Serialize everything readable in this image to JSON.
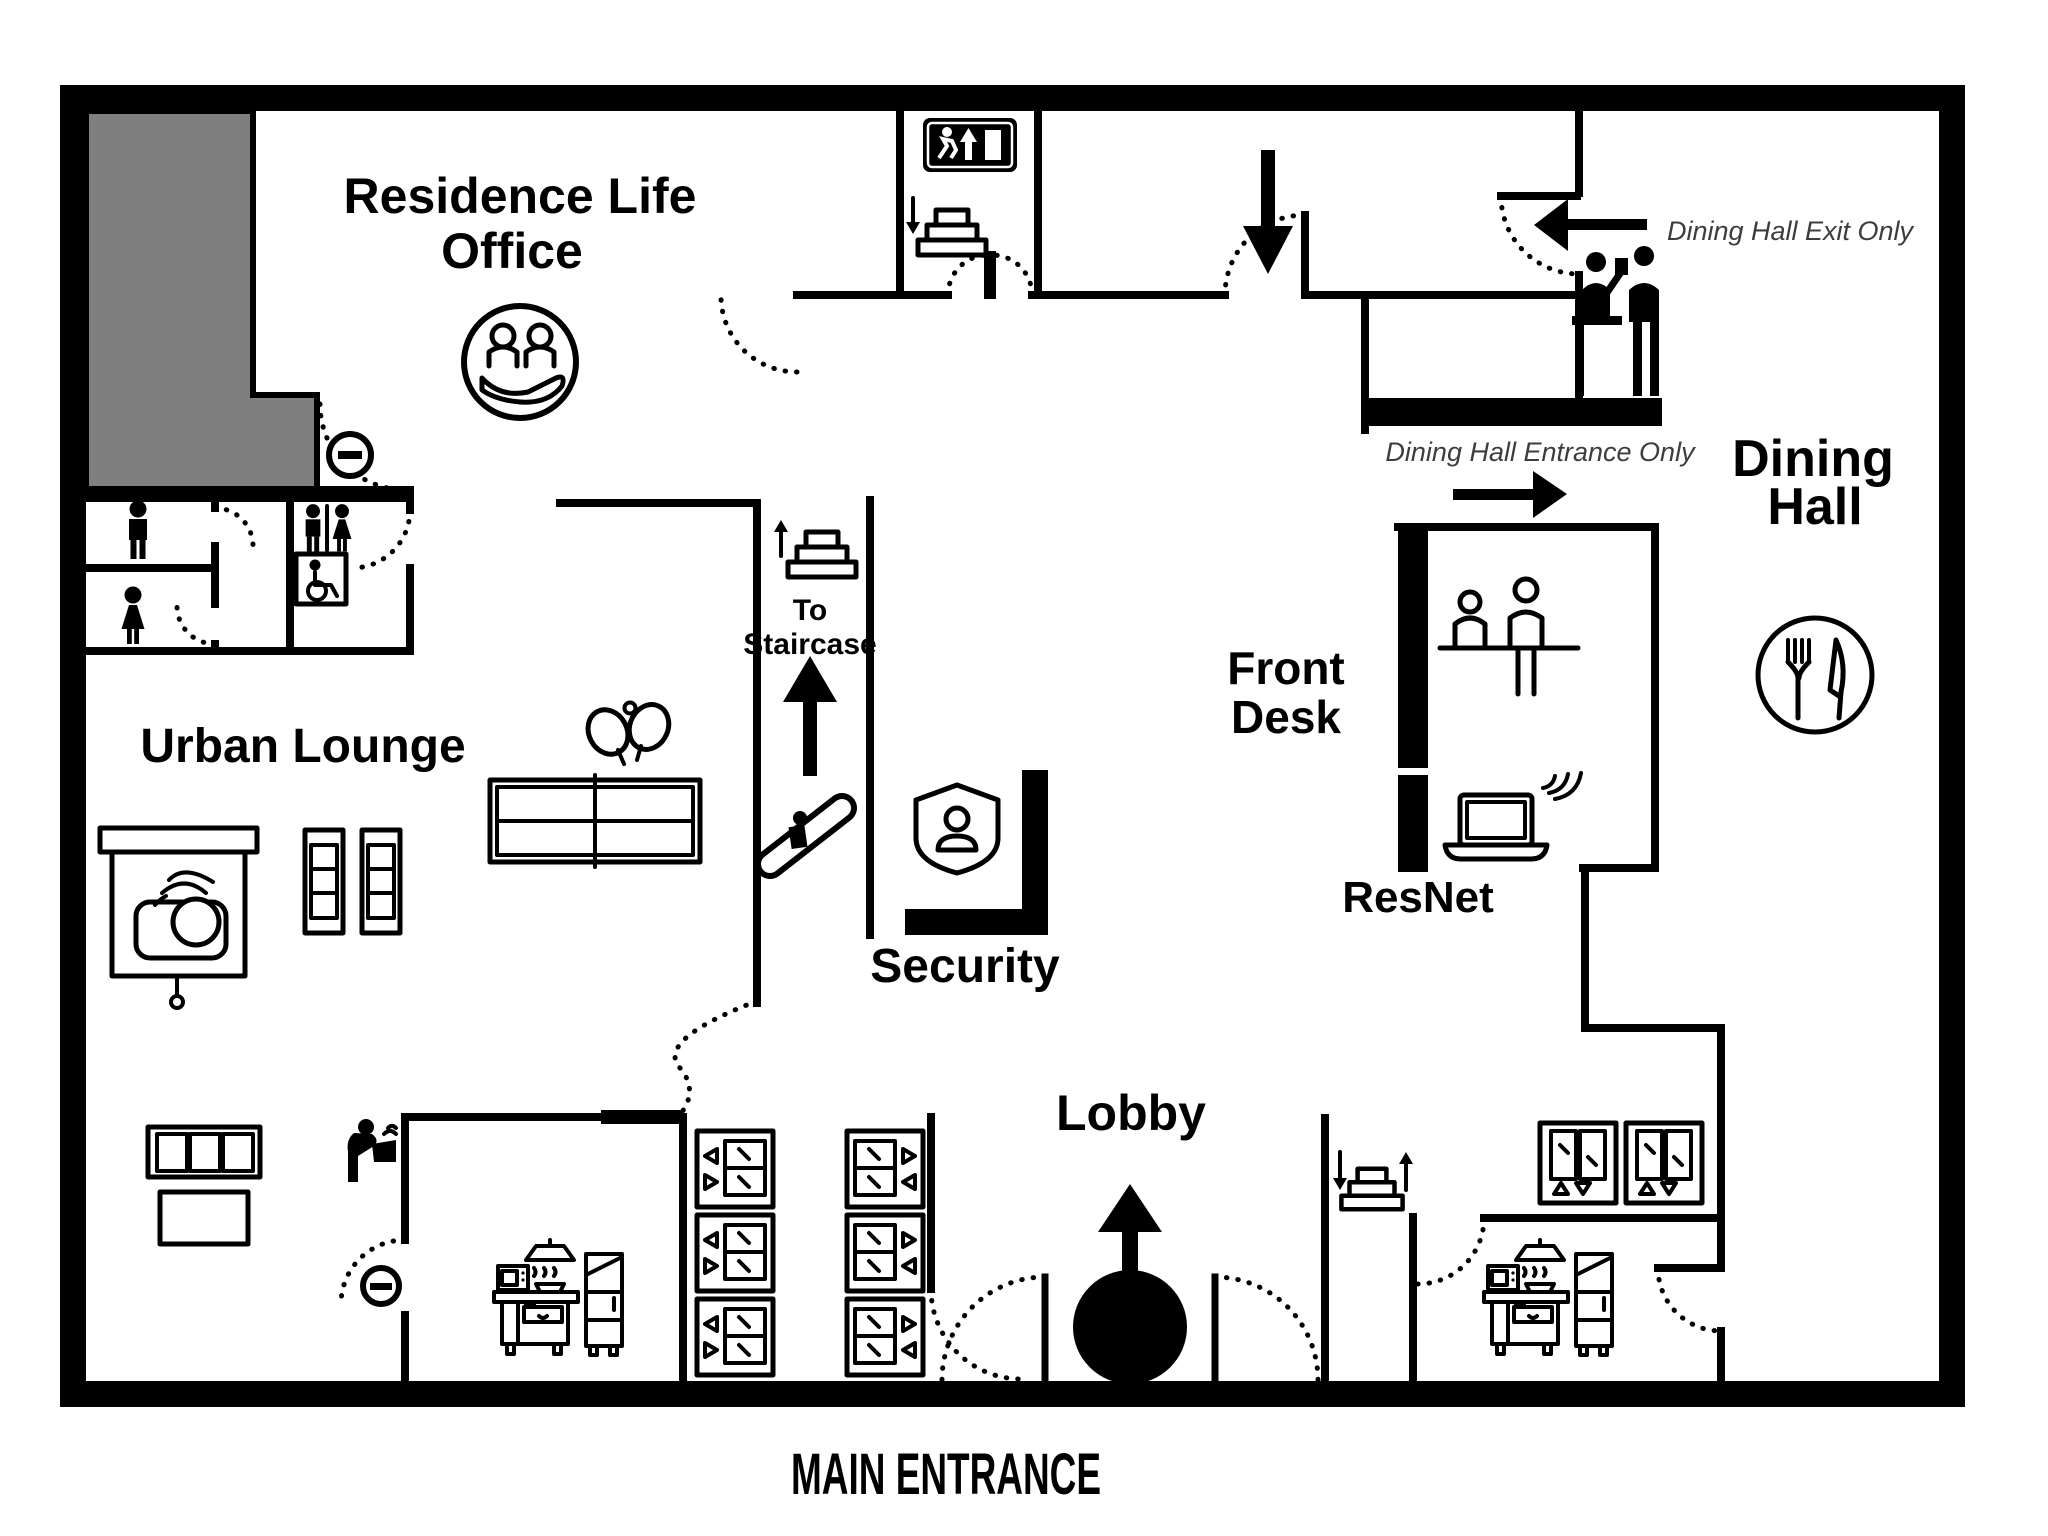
{
  "colors": {
    "wall": "#000000",
    "restricted_area_fill": "#7f7f7f",
    "background": "#ffffff",
    "annotation_text": "#3d3d3d"
  },
  "rooms": {
    "residence_life_office": {
      "line1": "Residence Life",
      "line2": "Office"
    },
    "urban_lounge": {
      "label": "Urban Lounge"
    },
    "security": {
      "label": "Security"
    },
    "lobby": {
      "label": "Lobby"
    },
    "front_desk": {
      "line1": "Front",
      "line2": "Desk"
    },
    "resnet": {
      "label": "ResNet"
    },
    "dining_hall": {
      "line1": "Dining",
      "line2": "Hall"
    }
  },
  "wayfinding": {
    "to_staircase": {
      "line1": "To",
      "line2": "Staircase"
    },
    "dining_hall_exit_only": "Dining Hall Exit Only",
    "dining_hall_entrance_only": "Dining Hall Entrance Only",
    "main_entrance": "MAIN ENTRANCE"
  },
  "icons": {
    "exit-sign-icon": "running man, up arrow, door on black sign",
    "stairs-down-icon": "stepped pyramid with down arrow",
    "stairs-up-icon": "stepped pyramid with up arrow",
    "stairs-up-down-icon": "stepped pyramid with down and up arrows",
    "escalator-icon": "person on inclined escalator band",
    "residence-life-icon": "two people held in a hand, circle badge",
    "no-entry-icon": "circle with horizontal bar",
    "mens-restroom-icon": "man pictogram",
    "womens-restroom-icon": "woman pictogram",
    "unisex-restroom-icon": "man and woman pictograms with divider",
    "wheelchair-accessible-icon": "wheelchair user in square sign",
    "security-shield-icon": "shield with person",
    "projector-screen-icon": "pull-down screen with wireless projector",
    "armchair-icon": "lounge chair seen from above",
    "ping-pong-table-icon": "table with net line and two paddles with ball",
    "sofa-icon": "three-seat couch with table",
    "drinking-fountain-icon": "person drinking from fountain",
    "kitchen-icon": "microwave, range with hood, fridge",
    "vending-machine-icon": "stacked units with arrows",
    "elevator-icon": "elevator doors with up/down triangles",
    "front-desk-attendant-icon": "two people at counter",
    "laptop-wifi-icon": "laptop with wireless waves",
    "dining-checkin-icon": "server and guest at counter",
    "fork-knife-plate-icon": "plate with fork and knife",
    "revolving-door-icon": "solid circle with up arrow",
    "door-swing-arc": "dotted quarter-circle door swing"
  }
}
